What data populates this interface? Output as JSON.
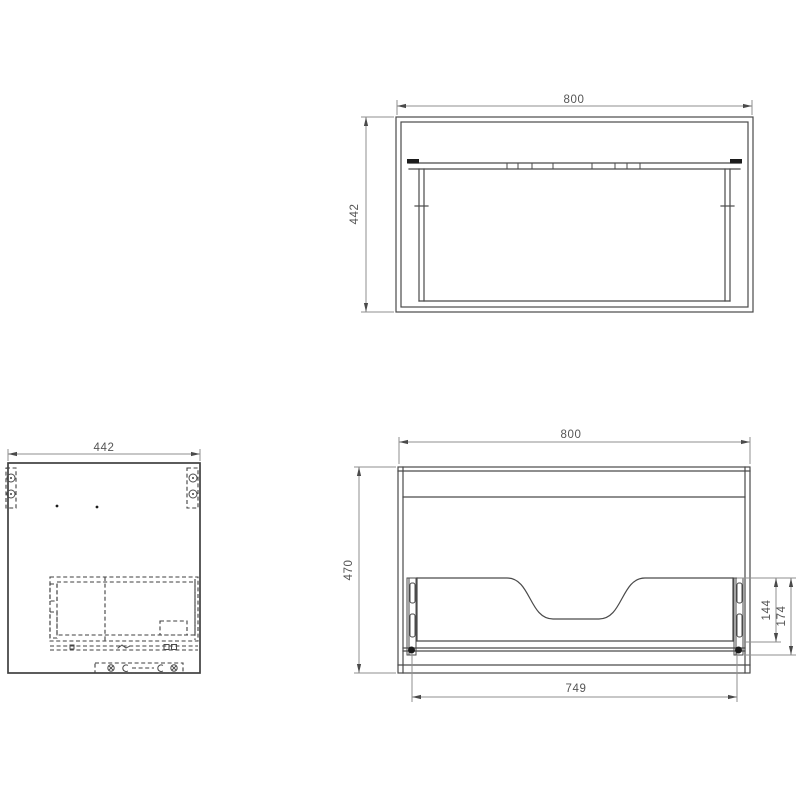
{
  "colors": {
    "object_line": "#4a4a4a",
    "hidden_line": "#3f3f3f",
    "dimension_line": "#8f8f8f",
    "dimension_text": "#555555",
    "background": "#ffffff"
  },
  "views": {
    "back": {
      "width": "800",
      "height": "442"
    },
    "side": {
      "depth": "442"
    },
    "front": {
      "width": "800",
      "height": "470",
      "opening_width": "749",
      "cutout_height": "144",
      "drawer_front_height": "174"
    }
  }
}
